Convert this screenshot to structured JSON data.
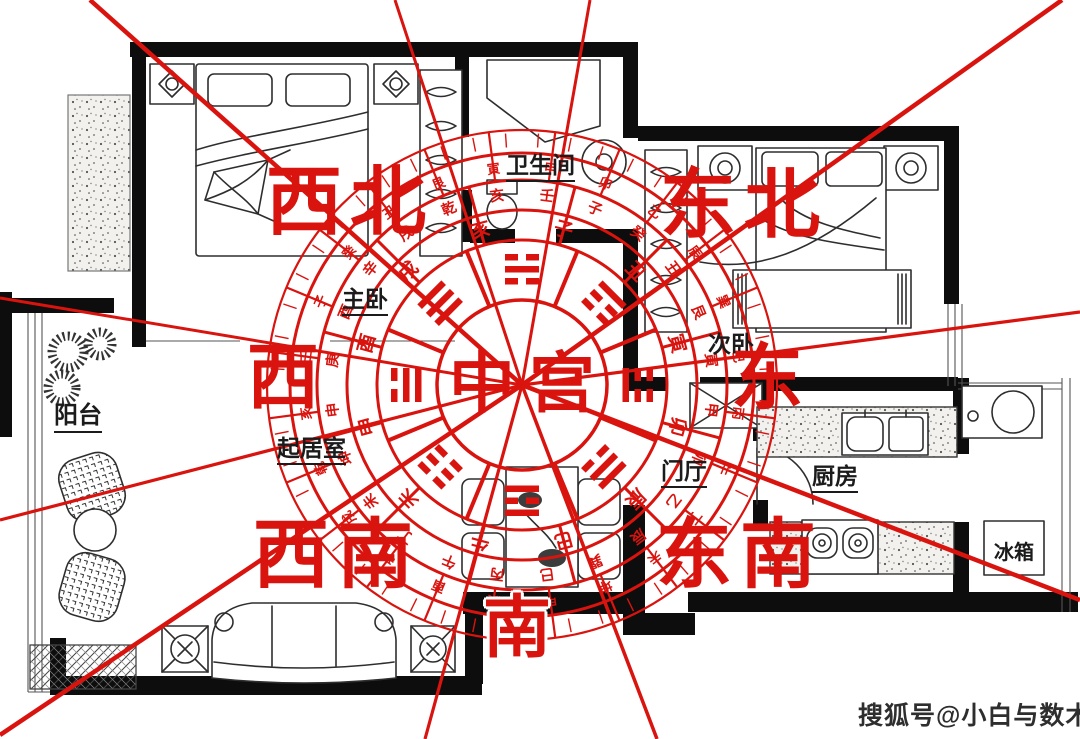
{
  "colors": {
    "accent_red": "#d9140f",
    "wall_black": "#0d0d0d"
  },
  "direction_labels": {
    "northwest": "西北",
    "northeast": "东北",
    "west": "西",
    "east": "东",
    "southwest": "西南",
    "southeast": "东南",
    "south": "南"
  },
  "room_labels": {
    "master_bedroom": "主卧",
    "bathroom": "卫生间",
    "second_bedroom": "次卧",
    "balcony": "阳台",
    "living_room": "起居室",
    "entry_hall": "门厅",
    "kitchen": "厨房",
    "fridge": "冰箱"
  },
  "watermark": "搜狐号@小白与数术",
  "compass": {
    "center_label": "中宫",
    "trigrams": [
      {
        "name": "kan",
        "lines": "010"
      },
      {
        "name": "gen",
        "lines": "001"
      },
      {
        "name": "zhen",
        "lines": "100"
      },
      {
        "name": "xun",
        "lines": "011"
      },
      {
        "name": "li",
        "lines": "101"
      },
      {
        "name": "kun",
        "lines": "000"
      },
      {
        "name": "dui",
        "lines": "110"
      },
      {
        "name": "qian",
        "lines": "111"
      }
    ],
    "rings": [
      {
        "name": "earthly-branches",
        "chars": [
          "子",
          "丑",
          "寅",
          "卯",
          "辰",
          "巳",
          "午",
          "未",
          "申",
          "酉",
          "戌",
          "亥"
        ]
      },
      {
        "name": "twenty-four-mountains",
        "chars": [
          "壬",
          "子",
          "癸",
          "丑",
          "艮",
          "寅",
          "甲",
          "卯",
          "乙",
          "辰",
          "巽",
          "巳",
          "丙",
          "午",
          "丁",
          "未",
          "坤",
          "申",
          "庚",
          "酉",
          "辛",
          "戌",
          "乾",
          "亥"
        ]
      },
      {
        "name": "twenty-four-mountains-outer",
        "chars": [
          "甲",
          "卯",
          "乙",
          "辰",
          "巽",
          "巳",
          "丙",
          "午",
          "丁",
          "未",
          "坤",
          "申",
          "庚",
          "酉",
          "辛",
          "戌",
          "乾",
          "亥",
          "壬",
          "子",
          "癸",
          "丑",
          "艮",
          "寅"
        ]
      }
    ]
  }
}
